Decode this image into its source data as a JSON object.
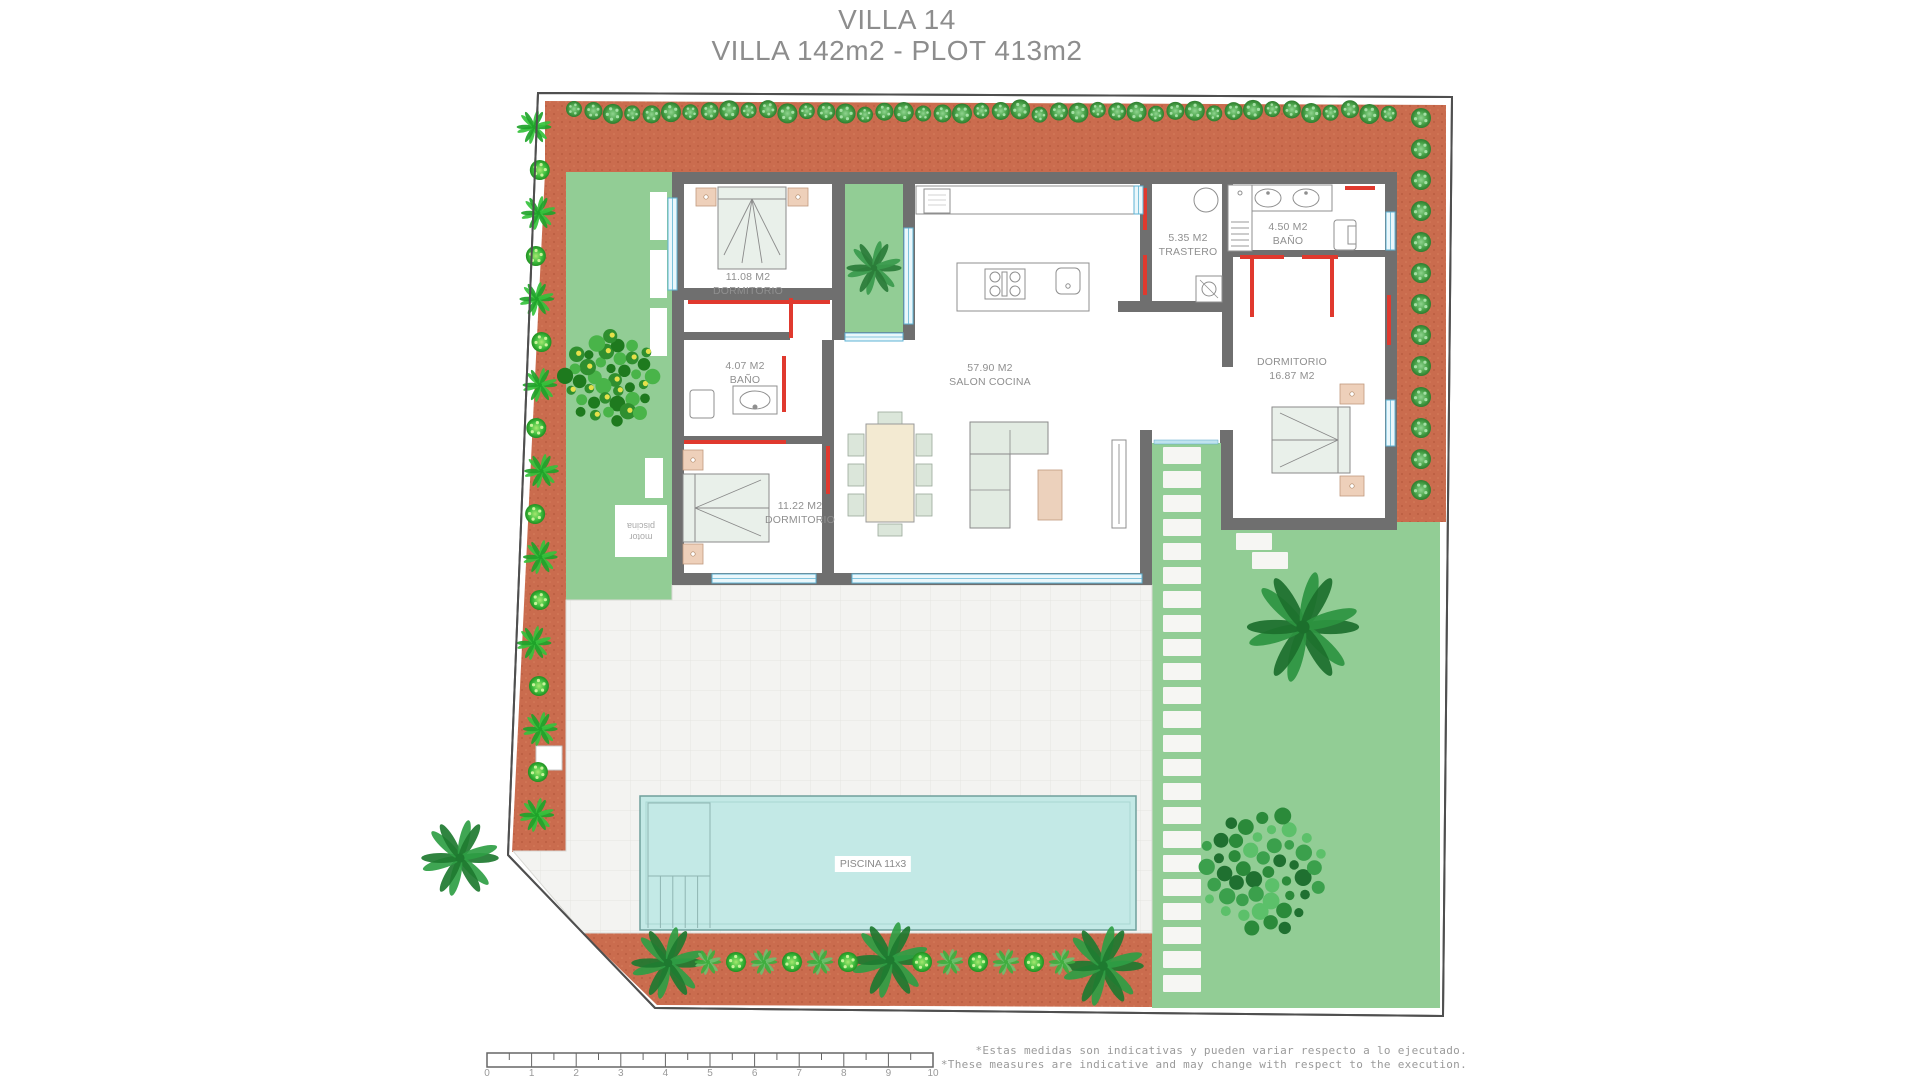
{
  "title": {
    "line1": "VILLA 14",
    "line2": "VILLA 142m2 - PLOT 413m2"
  },
  "rooms": [
    {
      "line1": "11.08 M2",
      "line2": "DORMITORIO"
    },
    {
      "line1": "4.07 M2",
      "line2": "BAÑO"
    },
    {
      "line1": "11.22 M2",
      "line2": "DORMITORIO"
    },
    {
      "line1": "57.90 M2",
      "line2": "SALON COCINA"
    },
    {
      "line1": "5.35 M2",
      "line2": "TRASTERO"
    },
    {
      "line1": "4.50 M2",
      "line2": "BAÑO"
    },
    {
      "line1": "DORMITORIO",
      "line2": "16.87 M2"
    }
  ],
  "pool": {
    "label": "PISCINA 11x3"
  },
  "pool_motor": {
    "line1": "motor",
    "line2": "piscina"
  },
  "scalebar": {
    "ticks": [
      "0",
      "1",
      "2",
      "3",
      "4",
      "5",
      "6",
      "7",
      "8",
      "9",
      "10"
    ]
  },
  "notes": {
    "es": "*Estas medidas son indicativas y pueden variar respecto a lo ejecutado.",
    "en": "*These measures are indicative and may change with respect to the execution."
  },
  "colors": {
    "terracotta": "#ca6c4e",
    "grass": "#92cd95",
    "pool": "#c3e9e6",
    "wall": "#6f6f6f",
    "accent_red": "#e0392e",
    "accent_blue": "#5fb3d4",
    "pavement": "#f3f3f1"
  }
}
